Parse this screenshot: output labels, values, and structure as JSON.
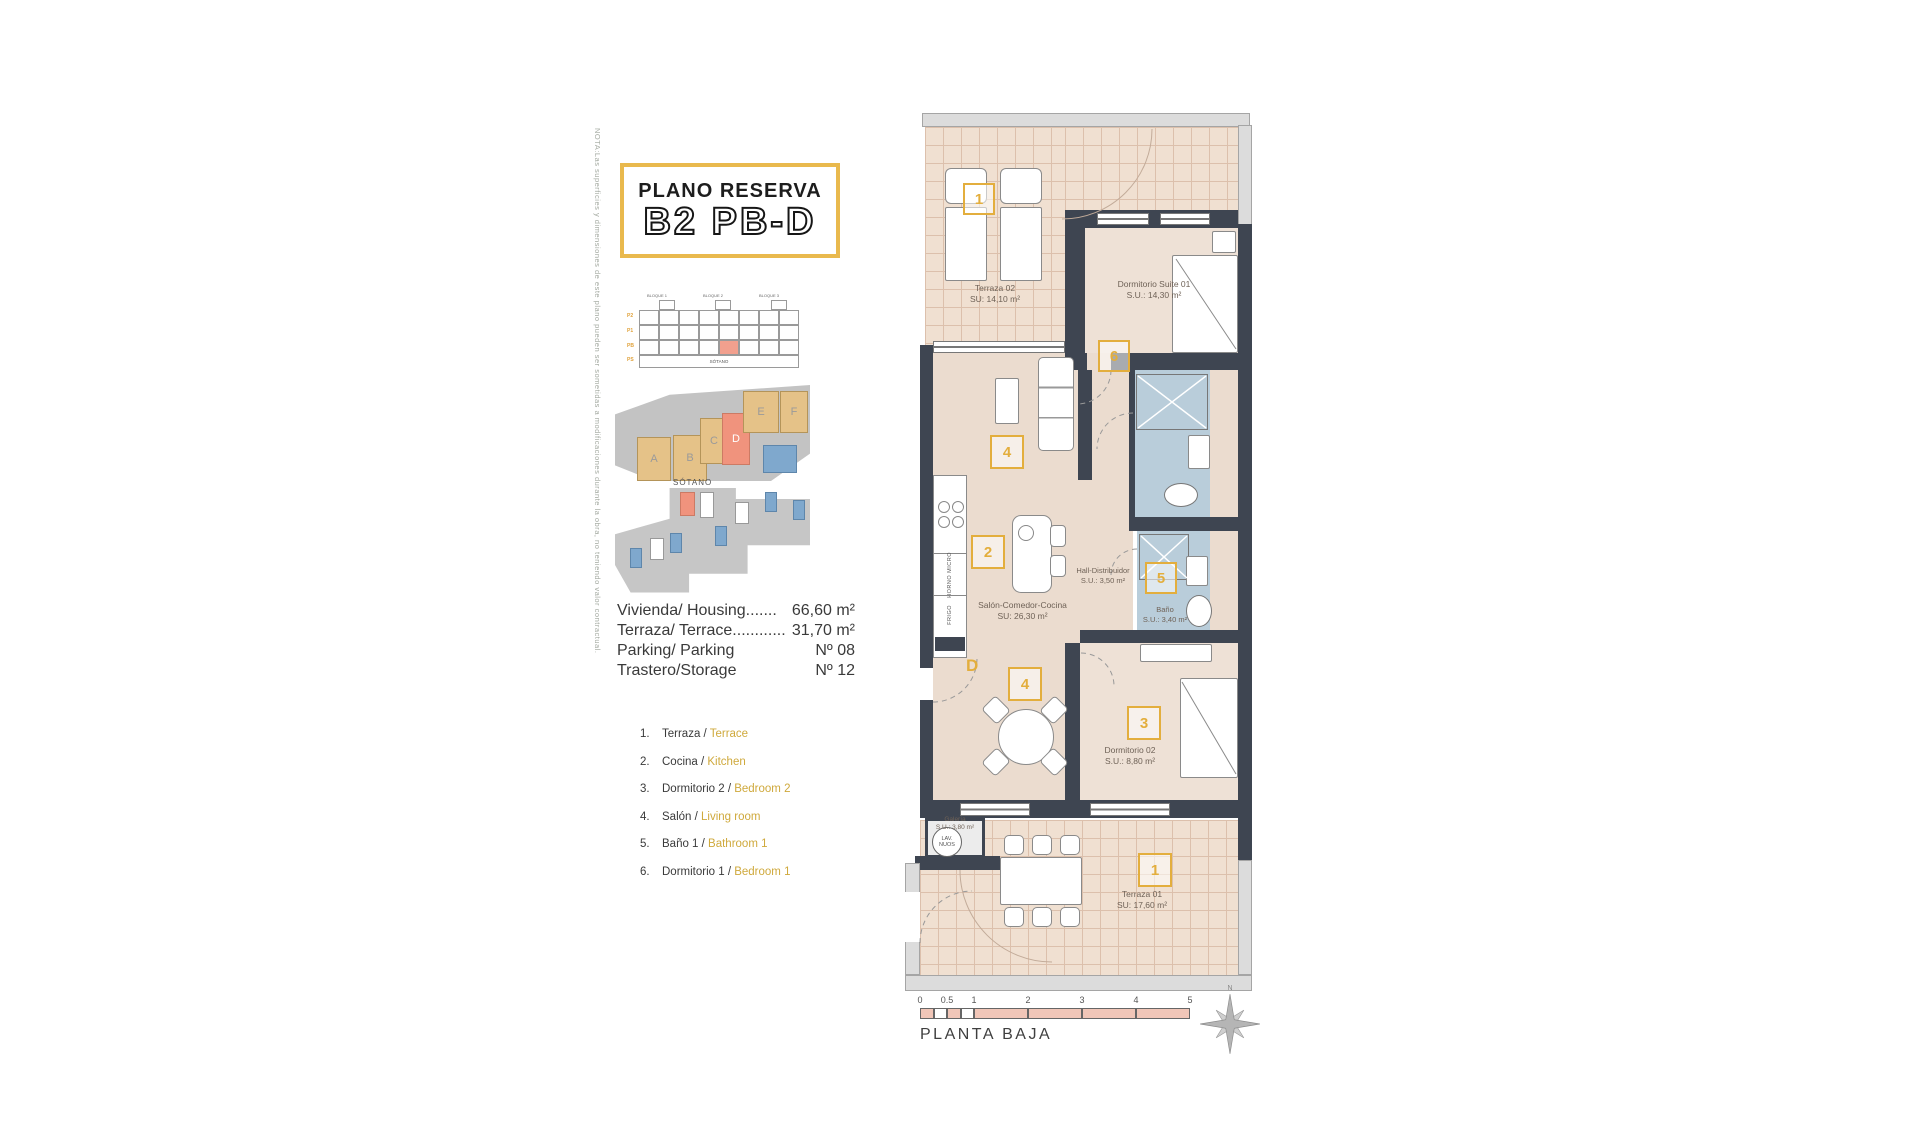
{
  "page": {
    "title_line1": "PLANO RESERVA",
    "title_line2": "B2 PB-D",
    "nota": "NOTA:Las superficies y dimensiones de este plano pueden ser sometidas a modificaciones durante la obra, no teniendo valor contractual.",
    "plan_name": "PLANTA BAJA"
  },
  "colors": {
    "accent_yellow": "#E3AE3D",
    "highlight_salmon": "#F0937D",
    "wall_dark": "#3E4551",
    "bath_blue": "#B9CDDA",
    "tile_beige": "#F0E0D1",
    "legend_english": "#CFA93C",
    "scale_pink": "#F1C6B8"
  },
  "elevation": {
    "block_labels": [
      "BLOQUE 1",
      "BLOQUE 2",
      "BLOQUE 3"
    ],
    "floor_labels": [
      "P2",
      "P1",
      "PB",
      "PS"
    ],
    "basement_label": "SÓTANO"
  },
  "site_plan": {
    "blocks": [
      "A",
      "B",
      "C",
      "D",
      "E",
      "F"
    ],
    "highlighted": "D"
  },
  "sotano": {
    "label": "SÓTANO"
  },
  "info": {
    "rows": [
      {
        "label": "Vivienda/ Housing.......",
        "value": "66,60 m²"
      },
      {
        "label": "Terraza/ Terrace............",
        "value": "31,70 m²"
      },
      {
        "label": "Parking/ Parking",
        "value": "Nº 08"
      },
      {
        "label": "Trastero/Storage",
        "value": "Nº 12"
      }
    ]
  },
  "legend": {
    "items": [
      {
        "num": "1.",
        "es": "Terraza /",
        "en": "Terrace"
      },
      {
        "num": "2.",
        "es": "Cocina /",
        "en": "Kitchen"
      },
      {
        "num": "3.",
        "es": "Dormitorio 2 /",
        "en": "Bedroom 2"
      },
      {
        "num": "4.",
        "es": "Salón /",
        "en": "Living room"
      },
      {
        "num": "5.",
        "es": "Baño 1 /",
        "en": "Bathroom 1"
      },
      {
        "num": "6.",
        "es": "Dormitorio 1 /",
        "en": "Bedroom 1"
      }
    ]
  },
  "plan": {
    "rooms": {
      "terraza02": {
        "name": "Terraza 02",
        "area": "SU: 14,10 m²"
      },
      "suite": {
        "name": "Dormitorio Suite 01",
        "area": "S.U.: 14,30 m²"
      },
      "salon": {
        "name": "Salón-Comedor-Cocina",
        "area": "SU: 26,30 m²"
      },
      "hall": {
        "name": "Hall-Distribuidor",
        "area": "S.U.: 3,50 m²"
      },
      "bano": {
        "name": "Baño",
        "area": "S.U.: 3,40 m²"
      },
      "dorm02": {
        "name": "Dormitorio 02",
        "area": "S.U.: 8,80 m²"
      },
      "galeria": {
        "name": "Galería",
        "area": "S.U.: 3,80 m²"
      },
      "terraza01": {
        "name": "Terraza 01",
        "area": "SU: 17,60 m²"
      }
    },
    "tags": {
      "terraza02": "1",
      "suite": "6",
      "living": "4",
      "kitchen": "2",
      "bath": "5",
      "dining": "4",
      "dorm02": "3",
      "terraza01": "1",
      "door": "D"
    },
    "kitchen_labels": {
      "oven": "HORNO",
      "micro": "MICRO",
      "fridge": "FRIGO"
    },
    "washer": {
      "line1": "LAV.",
      "line2": "NUOS"
    }
  },
  "scale_bar": {
    "ticks": [
      "0",
      "0.5",
      "1",
      "2",
      "3",
      "4",
      "5"
    ]
  },
  "compass": {
    "label": "N"
  }
}
